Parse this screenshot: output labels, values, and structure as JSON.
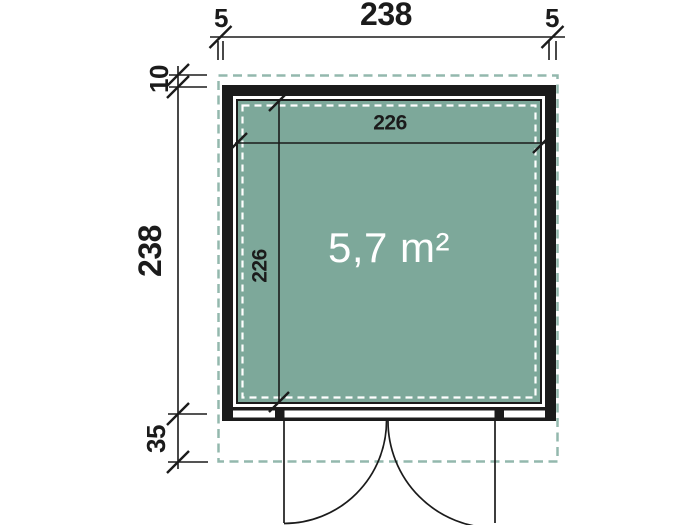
{
  "drawing": {
    "area_label": "5,7 m²",
    "dims": {
      "top_overhang_left": "5",
      "top_width": "238",
      "top_overhang_right": "5",
      "side_overhang_rear": "10",
      "side_depth": "238",
      "side_overhang_front": "35",
      "inner_width": "226",
      "inner_depth": "226"
    },
    "colors": {
      "floor": "#7DA89A",
      "overhang_dash": "#93B8AD",
      "line": "#1b1b1b",
      "inner_dash": "#ffffff",
      "area_text": "#ffffff"
    }
  }
}
